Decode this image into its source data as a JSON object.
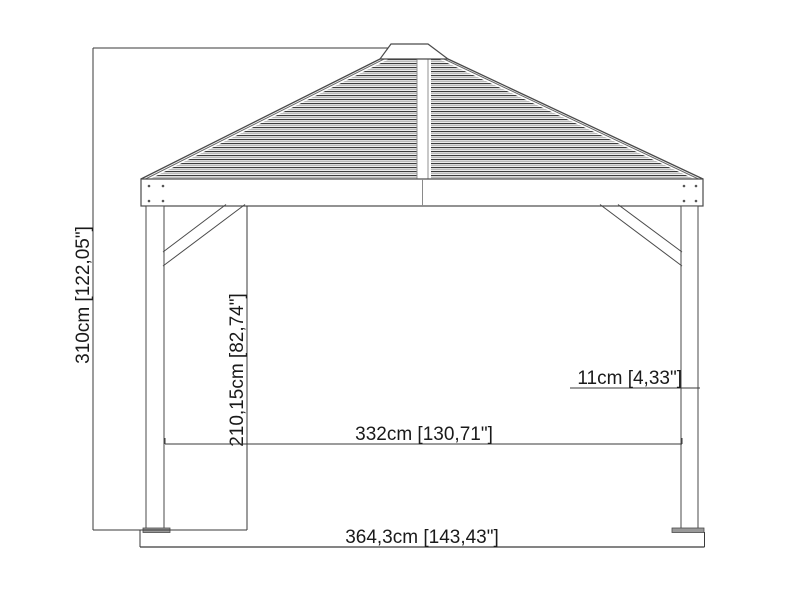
{
  "drawing": {
    "name": "Gazebo side elevation technical drawing",
    "background_color": "#ffffff",
    "line_color": "#4a4a4a",
    "dimension_line_color": "#3a3a3a",
    "text_color": "#1a1a1a",
    "roof_slat_dark_color": "#3c3c3c",
    "roof_slat_light_color": "#a8a8a8",
    "base_plate_color": "#999999",
    "dimensions": {
      "total_height": "310cm [122,05\"]",
      "clear_height": "210,15cm [82,74\"]",
      "post_width": "11cm [4,33\"]",
      "inner_width": "332cm [130,71\"]",
      "total_width": "364,3cm [143,43\"]"
    }
  }
}
